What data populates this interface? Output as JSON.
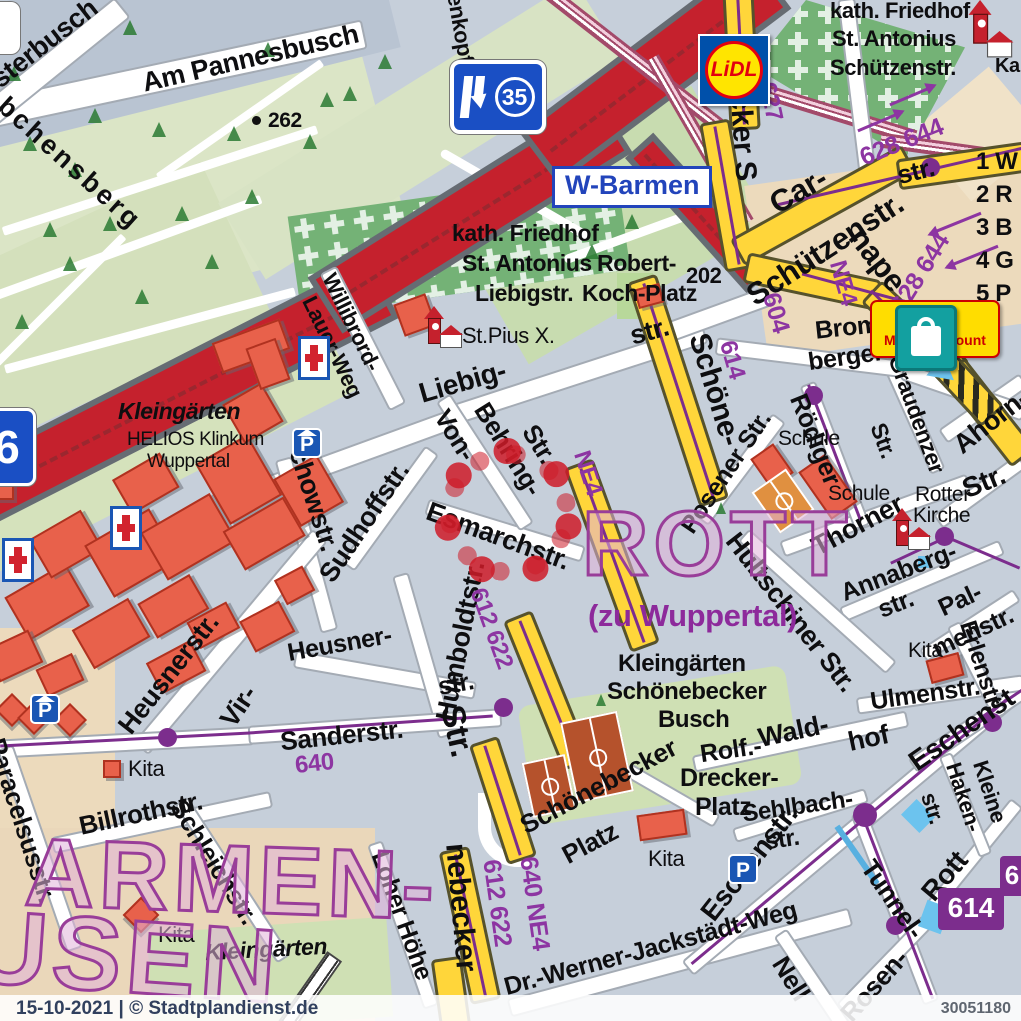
{
  "footer": {
    "date_copyright": "15-10-2021 | © Stadtplandienst.de",
    "map_id": "30051180"
  },
  "legend": {
    "items": [
      "1 W",
      "2 R",
      "3 B",
      "4 G",
      "5 P"
    ]
  },
  "districts": {
    "rott": "ROTT",
    "rott_suffix": "(zu Wuppertal)",
    "barmen_fragment": "ARMEN-",
    "hausen_fragment": "USEN"
  },
  "signs": {
    "motorway_exit_number": "35",
    "exit_name": "W-Barmen",
    "motorway_badge": "6",
    "lidl_logo": "LiDL",
    "market_logo_initial": "M",
    "market_logo_text": "Markt-Discount",
    "kapelle": "Kap"
  },
  "areas": {
    "kleingaerten": "Kleingärten",
    "helios_line1": "HELIOS Klinkum",
    "helios_line2": "Wuppertal",
    "cemetery_sw_line1": "kath. Friedhof",
    "cemetery_sw_line2": "St. Antonius",
    "cemetery_sw_line3": "Liebigstr.",
    "cemetery_ne_line1": "kath. Friedhof",
    "cemetery_ne_line2": "St. Antonius",
    "cemetery_ne_line3": "Schützenstr.",
    "robert_line1": "Robert-",
    "robert_line2": "Koch-Platz",
    "st_pius": "St.Pius X.",
    "schule": "Schule",
    "rotter_kirche_line1": "Rotter",
    "rotter_kirche_line2": "Kirche",
    "kita": "Kita",
    "busch_line1": "Kleingärten",
    "busch_line2": "Schönebecker",
    "busch_line3": "Busch",
    "kleingaerten_south": "Kleingärten",
    "elevation_262": "262",
    "house_202": "202"
  },
  "streets": {
    "sterbusch": "sterbusch",
    "am_pannesbusch": "Am Pannesbusch",
    "luebchensberg": "bchensberg",
    "enkopf": "enkopf",
    "liebig": "Liebig-",
    "liebig_end": "str.",
    "willibrord": "Willibrord-",
    "lauer_weg": "Lauer-Weg",
    "von": "Von-",
    "behring": "Behring-",
    "behring_str": "Str.",
    "esmarch": "Esmarchstr.",
    "sudhoff": "Sudhoffstr.",
    "humboldt": "Humboldtstr.",
    "virchow": "chowstr.",
    "vir": "Vir-",
    "heusner_diag": "Heusnerstr.",
    "heusner_a": "Heusner-",
    "heusner_b": "str.",
    "sander": "Sanderstr.",
    "billroth": "Billrothstr.",
    "paracelsus": "Paracelsusstr.",
    "schleich": "Schleichstr.",
    "loher_hoehe": "Loher Höhe",
    "schoenebecker_n": "becker S",
    "schoenebecker_mid": "Schöne-",
    "schoenebecker_str": "Str.",
    "schoenebecker_s": "nebecker",
    "schuetzenstr": "Schützenstr.",
    "schuetzen_end": "str.",
    "carnaper_a": "Car-",
    "carnaper_b": "nape",
    "bromberger_a": "Brom-",
    "bromberger_b": "berger",
    "roediger": "Rödiger",
    "posener": "Posener Str.",
    "graudenzer": "Graudenzer",
    "graudenzer_str": "Str.",
    "ahorn": "Ahorn-",
    "thorner": "Thorner",
    "rotter_str": "Str.",
    "hultschiner": "Hultschiner Str.",
    "annaberg_a": "Annaberg-",
    "annaberg_b": "str.",
    "pal": "Pal-",
    "menstr": "menstr.",
    "erlen": "Erlenstr.",
    "ulmen": "Ulmenstr.",
    "kleine": "Kleine",
    "haken": "Haken-",
    "haken_str": "str.",
    "rott": "Rott",
    "tunnel": "Tunnel-",
    "rosen": "Rosen-",
    "nell": "Nell",
    "jackstaedt": "Dr.-Werner-Jackstädt-Weg",
    "eschen_a": "Eschenst",
    "eschen_b": "Eschenstr.",
    "sehlbach_a": "Sehlbach-",
    "sehlbach_b": "str.",
    "rolf": "Rolf.-",
    "wald": "Wald-",
    "hof": "hof",
    "drecker_a": "Drecker-",
    "drecker_b": "Platz",
    "sb_platz_a": "Schönebecker",
    "sb_platz_b": "Platz"
  },
  "transit": {
    "r627": "627",
    "r628_644_a": "628 644",
    "r628_644_b": "628 644",
    "r604": "604",
    "r614": "614",
    "ne4_a": "NE4",
    "ne4_b": "NE4",
    "r612_622_a": "612 622",
    "r612_622_b": "612 622",
    "r640_ne4": "640 NE4",
    "r640": "640",
    "badge_614": "614",
    "badge_6": "6"
  }
}
